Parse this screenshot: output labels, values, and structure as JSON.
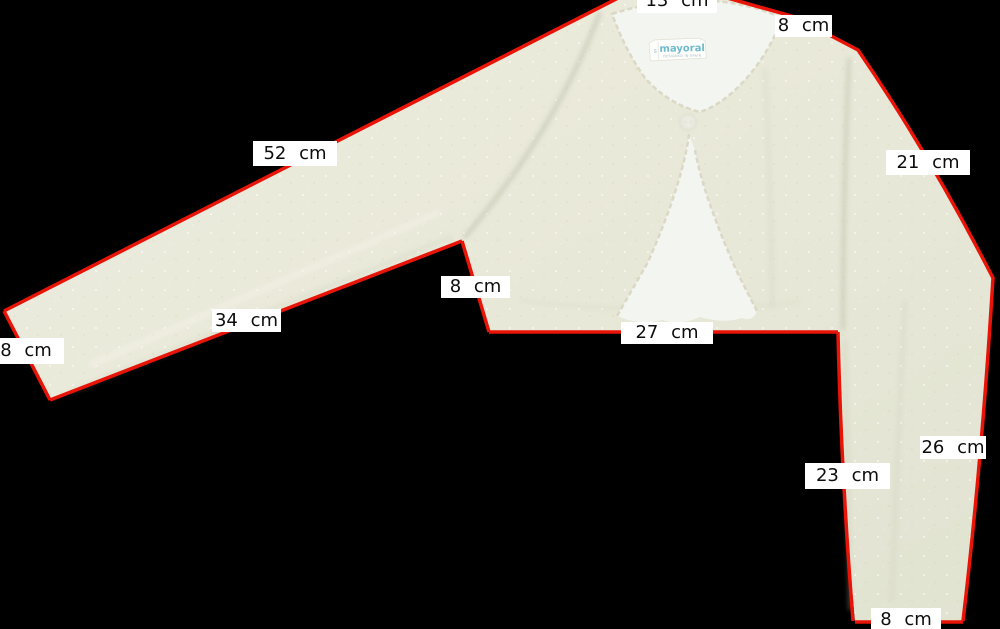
{
  "scene": {
    "description": "Flat-lay product photo of a cream knitted bolero cardigan on a black background, annotated with red measurement lines and white measurement labels",
    "background_color": "#000000"
  },
  "colors": {
    "scene-bg": "#000000",
    "measure-line": "#e81407",
    "label-bg": "#ffffff",
    "label-text": "#0d0d0d",
    "fabric": "#edecdf",
    "fabric-shade": "#e1e3d1",
    "lining": "#f3f5f0",
    "brand-text": "#70bacc"
  },
  "garment": {
    "tag": {
      "brand": "mayoral",
      "size": "s",
      "subtext": "DESIGNED IN SPAIN"
    }
  },
  "measurements": [
    {
      "name": "neck-width",
      "text": "13 cm"
    },
    {
      "name": "neck-to-shoulder",
      "text": "8 cm"
    },
    {
      "name": "left-sleeve-top-length",
      "text": "52 cm"
    },
    {
      "name": "right-shoulder-seam-length",
      "text": "21 cm"
    },
    {
      "name": "side-seam-height",
      "text": "8 cm"
    },
    {
      "name": "left-sleeve-underarm-length",
      "text": "34 cm"
    },
    {
      "name": "left-cuff-width",
      "text": "8 cm"
    },
    {
      "name": "hem-width",
      "text": "27 cm"
    },
    {
      "name": "right-sleeve-outer-length",
      "text": "26 cm"
    },
    {
      "name": "right-sleeve-inner-length",
      "text": "23 cm"
    },
    {
      "name": "right-cuff-width",
      "text": "8 cm"
    }
  ]
}
